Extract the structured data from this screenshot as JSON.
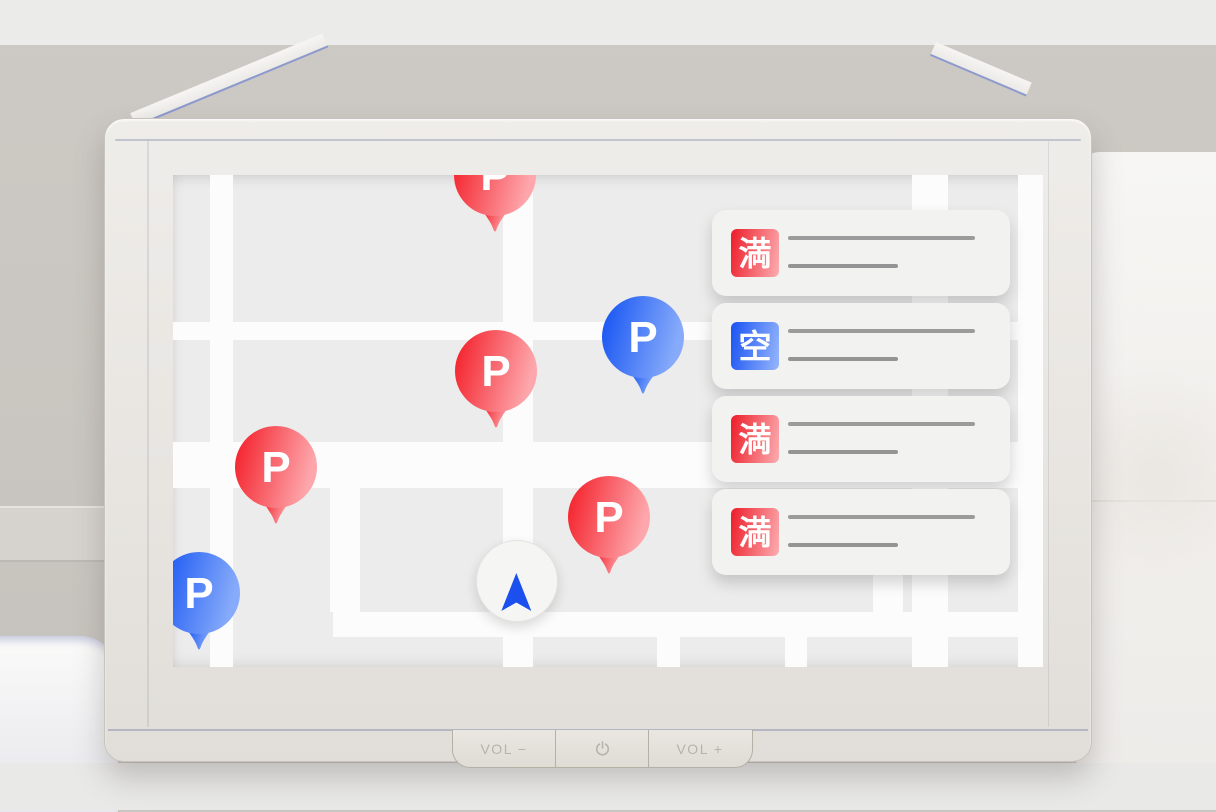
{
  "device": {
    "hardware_buttons": [
      {
        "id": "vol-down",
        "label": "VOL −",
        "icon": null
      },
      {
        "id": "power",
        "label": "",
        "icon": "power-icon"
      },
      {
        "id": "vol-up",
        "label": "VOL +",
        "icon": null
      }
    ]
  },
  "map": {
    "pins": [
      {
        "id": "pin-1",
        "letter": "P",
        "color": "red",
        "status_meaning": "full",
        "cx": 322,
        "cy": 0
      },
      {
        "id": "pin-2",
        "letter": "P",
        "color": "blue",
        "status_meaning": "vacant",
        "cx": 470,
        "cy": 162
      },
      {
        "id": "pin-3",
        "letter": "P",
        "color": "red",
        "status_meaning": "full",
        "cx": 323,
        "cy": 196
      },
      {
        "id": "pin-4",
        "letter": "P",
        "color": "red",
        "status_meaning": "full",
        "cx": 103,
        "cy": 292
      },
      {
        "id": "pin-5",
        "letter": "P",
        "color": "red",
        "status_meaning": "full",
        "cx": 436,
        "cy": 342
      },
      {
        "id": "pin-6",
        "letter": "P",
        "color": "blue",
        "status_meaning": "vacant",
        "cx": 26,
        "cy": 418
      }
    ],
    "current_location": {
      "cx": 344,
      "cy": 406
    },
    "roads": [
      {
        "x": 37,
        "y": 0,
        "w": 23,
        "h": 492
      },
      {
        "x": 330,
        "y": 0,
        "w": 30,
        "h": 492
      },
      {
        "x": 739,
        "y": 0,
        "w": 36,
        "h": 492
      },
      {
        "x": 845,
        "y": 0,
        "w": 26,
        "h": 492
      },
      {
        "x": 157,
        "y": 313,
        "w": 30,
        "h": 124
      },
      {
        "x": 700,
        "y": 400,
        "w": 30,
        "h": 37
      },
      {
        "x": 484,
        "y": 462,
        "w": 23,
        "h": 30
      },
      {
        "x": 612,
        "y": 462,
        "w": 22,
        "h": 30
      },
      {
        "x": 0,
        "y": 147,
        "w": 870,
        "h": 18
      },
      {
        "x": 0,
        "y": 267,
        "w": 870,
        "h": 46
      },
      {
        "x": 160,
        "y": 437,
        "w": 710,
        "h": 25
      }
    ]
  },
  "panel": {
    "cards": [
      {
        "id": "card-1",
        "status_label": "満",
        "status_meaning": "full",
        "badge_color": "red"
      },
      {
        "id": "card-2",
        "status_label": "空",
        "status_meaning": "vacant",
        "badge_color": "blue"
      },
      {
        "id": "card-3",
        "status_label": "満",
        "status_meaning": "full",
        "badge_color": "red"
      },
      {
        "id": "card-4",
        "status_label": "満",
        "status_meaning": "full",
        "badge_color": "red"
      }
    ]
  },
  "colors": {
    "map_background": "#ececec",
    "road_white": "#fcfcfc",
    "card_background": "#f2f2f1",
    "placeholder_line_gray": "#9b9b9b",
    "location_arrow_blue": "#1b50ef",
    "bezel_accent_blue": "#8d9ace",
    "pin_red_gradient": [
      "#f4252f",
      "#fda6ab"
    ],
    "pin_blue_gradient": [
      "#1b58f3",
      "#87abfa"
    ],
    "badge_red_gradient": [
      "#ee2430",
      "#fba6aa"
    ],
    "badge_blue_gradient": [
      "#2058f3",
      "#90b1fb"
    ]
  }
}
